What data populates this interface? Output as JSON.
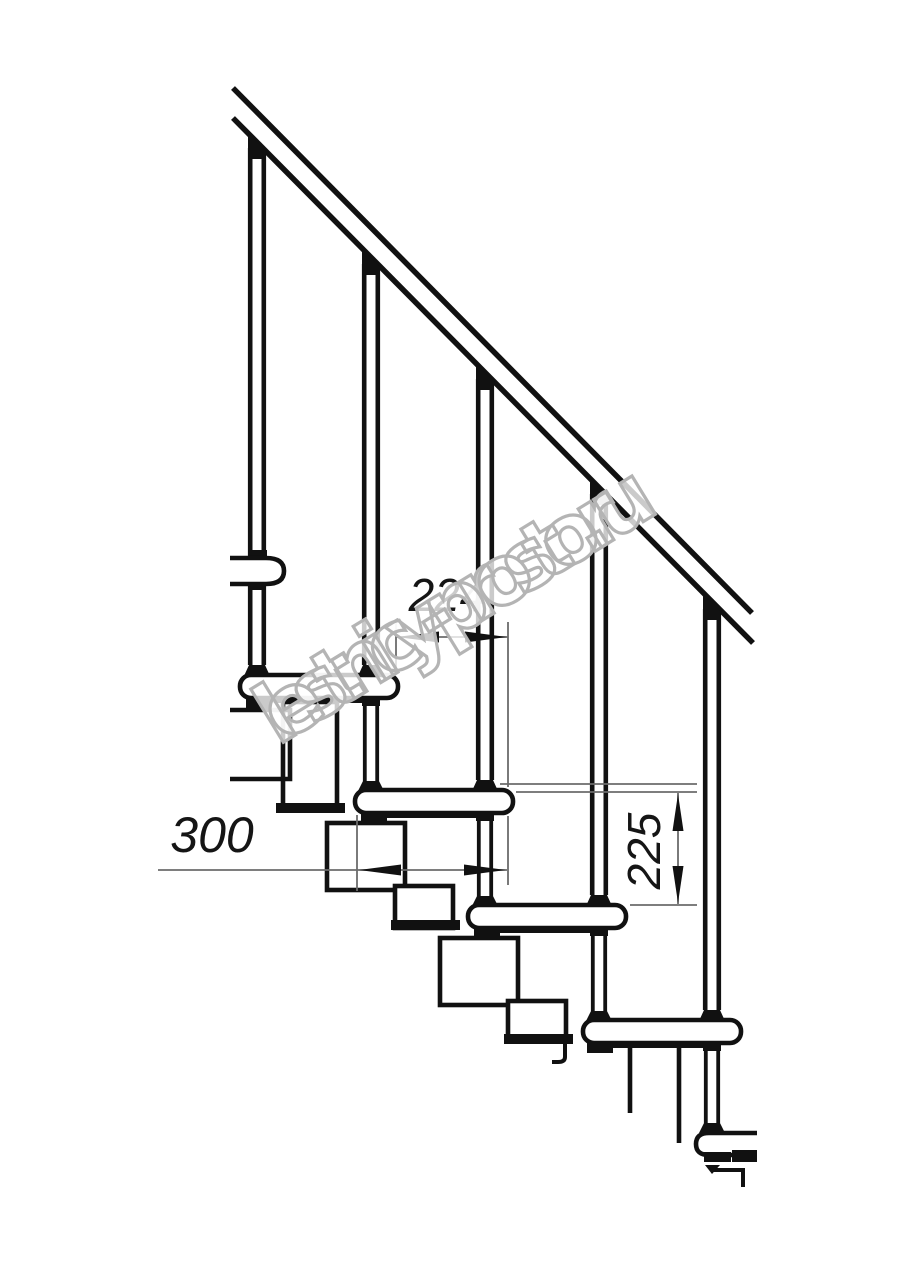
{
  "page": {
    "background": "#ffffff",
    "kind": "technical line drawing",
    "subject": "modular staircase fragment, side elevation"
  },
  "drawing": {
    "line_color": "#111111",
    "dimension_line_color": "#6b6b6b",
    "handrail": "double diagonal rail descending left to right",
    "baluster_count": 5,
    "tread_count": 5,
    "support": "chain of rectangular modules under treads"
  },
  "dimensions": {
    "going": {
      "value": "224",
      "orientation": "horizontal",
      "units": "mm"
    },
    "tread_depth": {
      "value": "300",
      "orientation": "horizontal",
      "units": "mm"
    },
    "rise": {
      "value": "225",
      "orientation": "vertical",
      "units": "mm"
    }
  },
  "watermark": {
    "text": "lestnicy-prosto.ru",
    "color": "#b4b4b4"
  }
}
